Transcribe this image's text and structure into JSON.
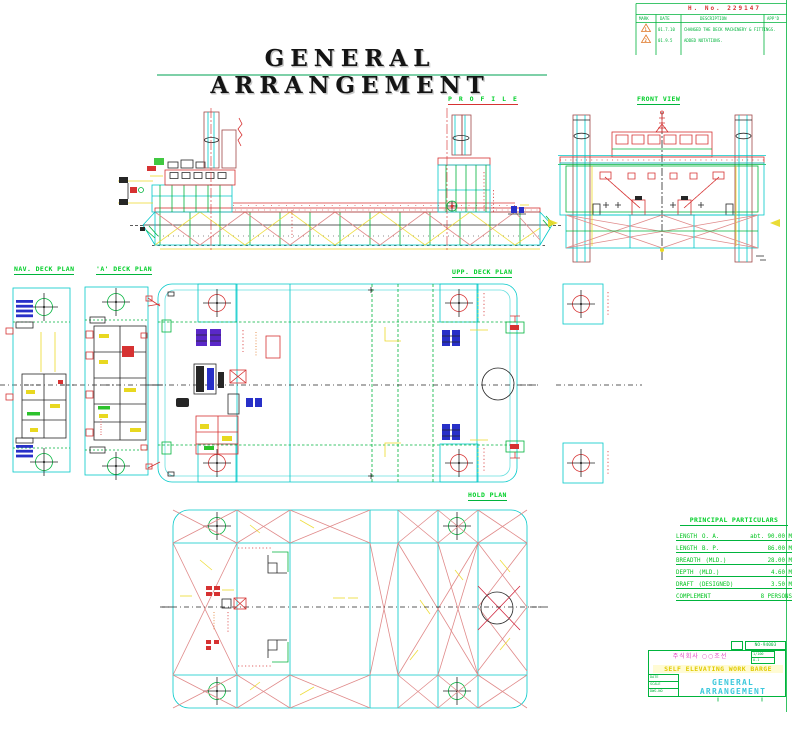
{
  "main_title": "GENERAL ARRANGEMENT",
  "revision_block": {
    "doc_no": "H. No. 229147",
    "headers": [
      "MARK",
      "DATE",
      "DESCRIPTION",
      "APP'D"
    ],
    "rows": [
      {
        "mark": "1",
        "date": "01.7.10",
        "desc": "CHANGED THE DECK MACHINERY & FITTINGS."
      },
      {
        "mark": "2",
        "date": "01.9.5",
        "desc": "ADDED NOTATIONS."
      }
    ]
  },
  "views": {
    "profile": {
      "label": "P R O F I L E"
    },
    "front": {
      "label": "FRONT VIEW"
    },
    "nav_deck": {
      "label": "NAV. DECK PLAN"
    },
    "a_deck": {
      "label": "'A' DECK PLAN"
    },
    "upp_deck": {
      "label": "UPP. DECK PLAN"
    },
    "hold": {
      "label": "HOLD PLAN"
    }
  },
  "particulars": {
    "title": "PRINCIPAL PARTICULARS",
    "rows": [
      {
        "label": "LENGTH",
        "qualifier": "O. A.",
        "value": "abt. 90.00 M"
      },
      {
        "label": "LENGTH",
        "qualifier": "B. P.",
        "value": "86.00 M"
      },
      {
        "label": "BREADTH",
        "qualifier": "(MLD.)",
        "value": "28.00 M"
      },
      {
        "label": "DEPTH",
        "qualifier": "(MLD.)",
        "value": "4.60 M"
      },
      {
        "label": "DRAFT",
        "qualifier": "(DESIGNED)",
        "value": "3.50 M"
      },
      {
        "label": "COMPLEMENT",
        "qualifier": "",
        "value": "8 PERSONS"
      }
    ]
  },
  "title_block": {
    "box_no": "NO-94003",
    "company": "주식회사 ○○조선",
    "scale_cell": "1/100",
    "no_cell": "A-1",
    "ship_line": "SELF ELEVATING WORK BARGE",
    "left_cells": [
      "DATE",
      "SCALE",
      "DWG.NO"
    ],
    "drawing_title": "GENERAL ARRANGEMENT"
  },
  "colors": {
    "cad_cyan": "#00c9c9",
    "cad_green": "#00b43c",
    "cad_red": "#d63232",
    "cad_yellow": "#ecd928",
    "cad_magenta": "#e040c0",
    "cad_blue": "#2830c8"
  }
}
